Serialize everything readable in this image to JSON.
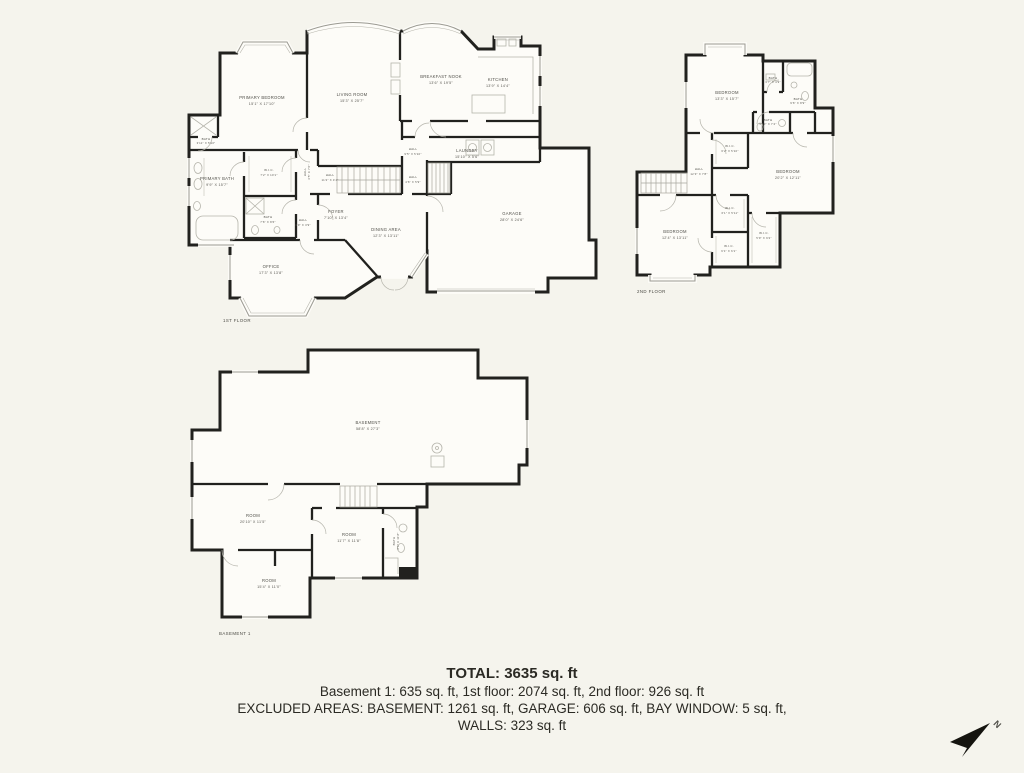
{
  "colors": {
    "background": "#F5F4ED",
    "floor_fill": "#FDFCF8",
    "wall": "#21211E",
    "detail_line": "#B5B4AB",
    "label_text": "#504F49"
  },
  "summary": {
    "total": "TOTAL: 3635 sq. ft",
    "floors_line": "Basement 1: 635 sq. ft, 1st floor: 2074 sq. ft, 2nd floor: 926 sq. ft",
    "excluded_line": "EXCLUDED AREAS: BASEMENT: 1261 sq. ft, GARAGE: 606 sq. ft, BAY WINDOW: 5 sq. ft,",
    "walls_line": "WALLS: 323 sq. ft"
  },
  "compass": {
    "label": "N"
  },
  "floors": {
    "first": {
      "caption": "1ST FLOOR",
      "rooms": [
        {
          "name": "PRIMARY BEDROOM",
          "dims": "15'1\" X 17'10\""
        },
        {
          "name": "LIVING ROOM",
          "dims": "15'3\" X 25'7\""
        },
        {
          "name": "BREAKFAST NOOK",
          "dims": "13'6\" X 19'5\""
        },
        {
          "name": "KITCHEN",
          "dims": "13'9\" X 14'4\""
        },
        {
          "name": "BATH",
          "dims": "3'11\" X 5'10\""
        },
        {
          "name": "PRIMARY BATH",
          "dims": "9'9\" X 15'7\""
        },
        {
          "name": "W.I.C.",
          "dims": "7'2\" X 10'1\""
        },
        {
          "name": "HALL",
          "dims": "3'5\" X 7'6\""
        },
        {
          "name": "HALL",
          "dims": "11'2\" X 4'4\""
        },
        {
          "name": "HALL",
          "dims": "9'5\" X 5'10\""
        },
        {
          "name": "LAUNDRY",
          "dims": "15'10\" X 5'6\""
        },
        {
          "name": "HALL",
          "dims": "4'6\" X 5'9\""
        },
        {
          "name": "FOYER",
          "dims": "7'10\" X 13'4\""
        },
        {
          "name": "BATH",
          "dims": "7'6\" X 8'6\""
        },
        {
          "name": "HALL",
          "dims": "3'9\" X 3'9\""
        },
        {
          "name": "DINING AREA",
          "dims": "12'3\" X 13'11\""
        },
        {
          "name": "GARAGE",
          "dims": "28'0\" X 24'6\""
        },
        {
          "name": "OFFICE",
          "dims": "17'3\" X 13'8\""
        }
      ]
    },
    "second": {
      "caption": "2ND FLOOR",
      "rooms": [
        {
          "name": "BEDROOM",
          "dims": "13'3\" X 15'7\""
        },
        {
          "name": "BATH",
          "dims": "3'7\" X 4'9\""
        },
        {
          "name": "BATH",
          "dims": "9'6\" X 8'9\""
        },
        {
          "name": "BATH",
          "dims": "5'10\" X 7'4\""
        },
        {
          "name": "W.I.C.",
          "dims": "6'2\" X 5'10\""
        },
        {
          "name": "HALL",
          "dims": "12'3\" X 7'8\""
        },
        {
          "name": "BEDROOM",
          "dims": "20'2\" X 12'11\""
        },
        {
          "name": "W.I.C.",
          "dims": "6'1\" X 5'11\""
        },
        {
          "name": "BEDROOM",
          "dims": "12'4\" X 13'11\""
        },
        {
          "name": "W.I.C.",
          "dims": "6'1\" X 6'1\""
        },
        {
          "name": "W.I.C.",
          "dims": "5'9\" X 9'2\""
        }
      ]
    },
    "basement": {
      "caption": "BASEMENT 1",
      "rooms": [
        {
          "name": "BASEMENT",
          "dims": "58'8\" X 27'3\""
        },
        {
          "name": "ROOM",
          "dims": "20'10\" X 11'5\""
        },
        {
          "name": "ROOM",
          "dims": "11'7\" X 11'8\""
        },
        {
          "name": "BATH",
          "dims": "6'0\" X 11'8\""
        },
        {
          "name": "ROOM",
          "dims": "15'4\" X 11'0\""
        }
      ]
    }
  }
}
